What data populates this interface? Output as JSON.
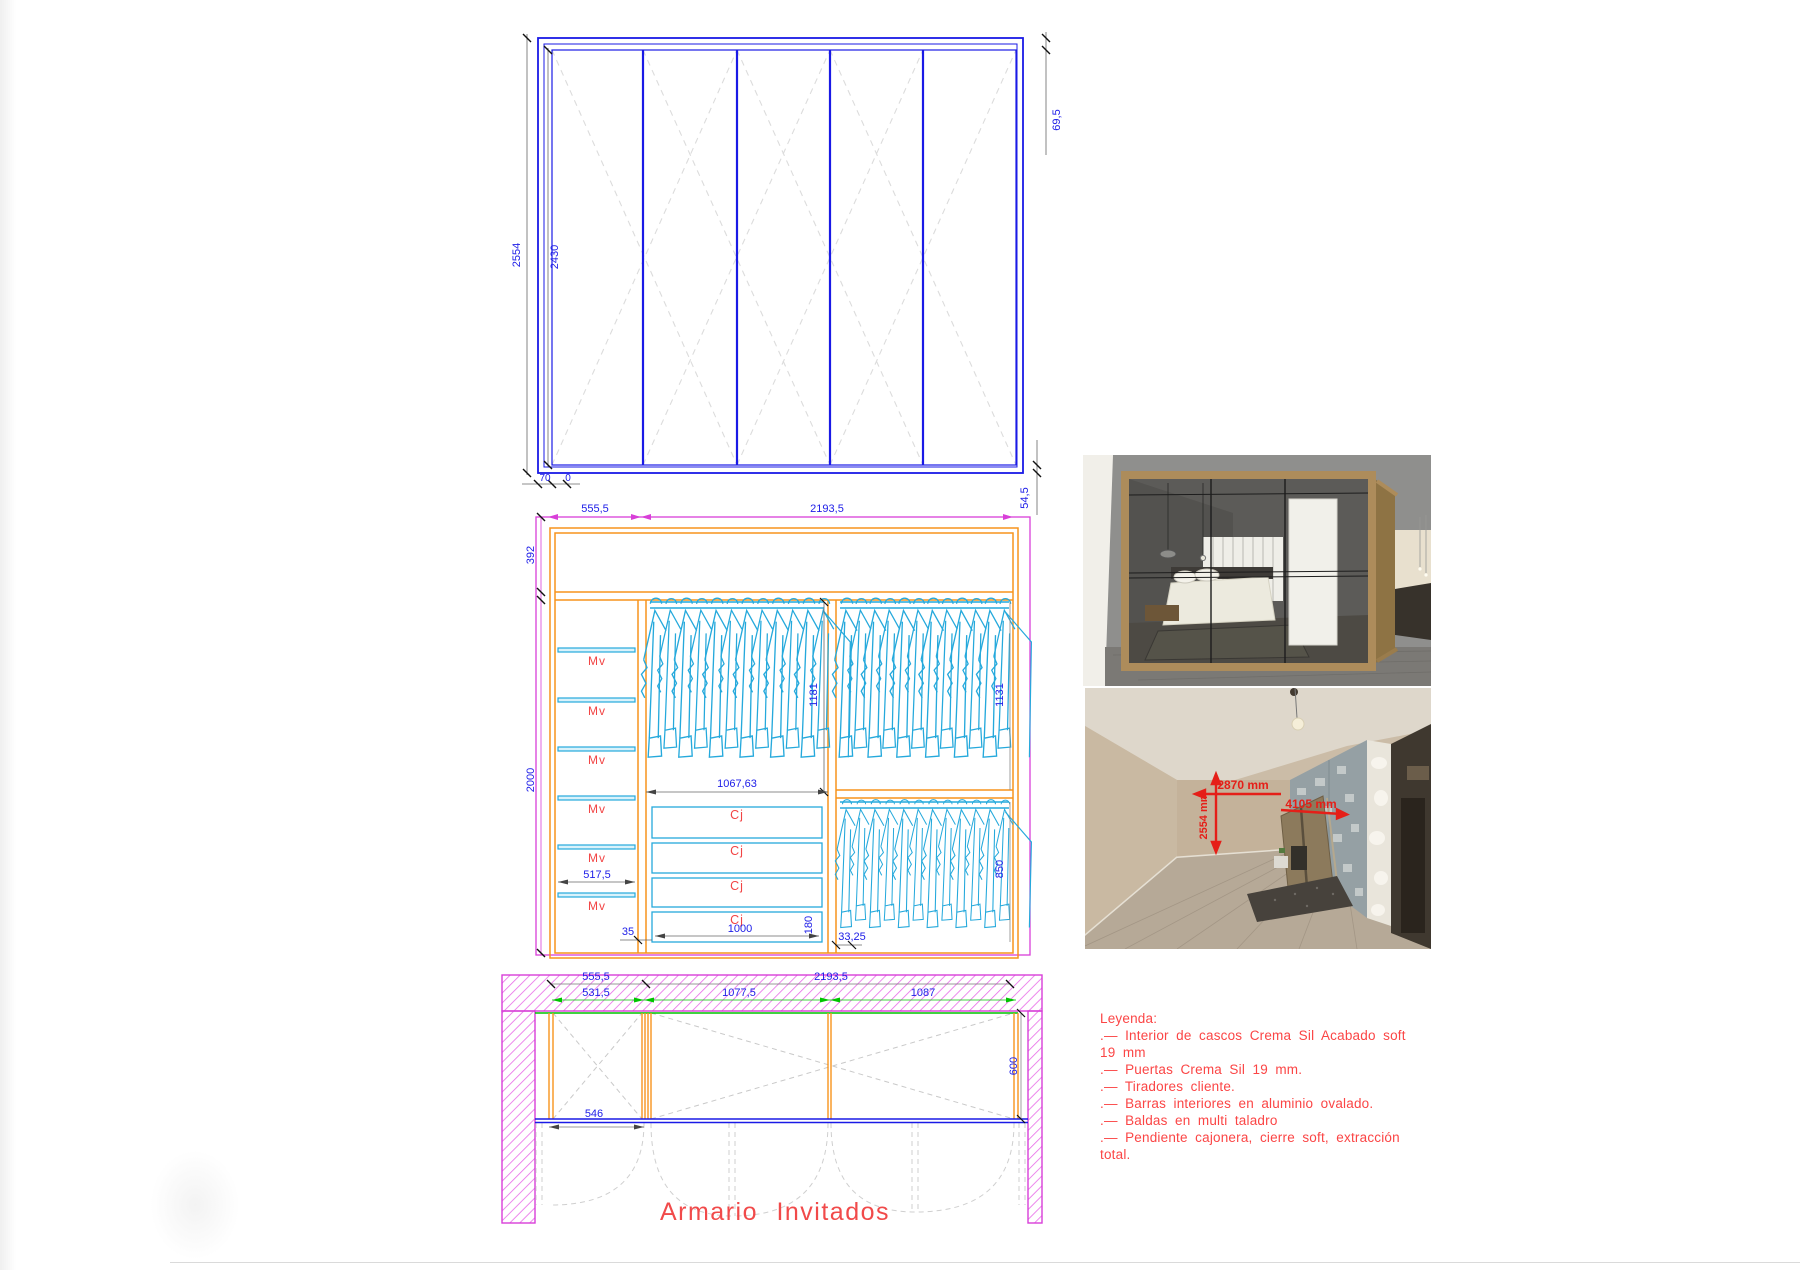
{
  "title": "Armario Invitados",
  "colors": {
    "line_blue": "#1a1ae6",
    "dim_blue": "#2020e8",
    "orange": "#f7941d",
    "cyan": "#25a9dc",
    "magenta": "#d83fd8",
    "green": "#00c400",
    "red_text": "#f24444",
    "photo_red": "#e51f18"
  },
  "elevation": {
    "door_count": 5,
    "dims": {
      "total_height": "2554",
      "door_height": "2430",
      "top_gap": "69,5",
      "bottom_offset": "70",
      "bottom_zero": "0",
      "side_gap": "54,5"
    }
  },
  "section": {
    "dims": {
      "left_width": "555,5",
      "right_width": "2193,5",
      "top_height": "392",
      "body_height": "2000",
      "shelf_width": "517,5",
      "left_rod_height": "1181",
      "rod_width": "1067,63",
      "right_rod_height": "1131",
      "lower_rod_height": "850",
      "drawer_width": "1000",
      "drawer_height": "180",
      "base_left": "35",
      "base_right": "33,25"
    },
    "shelf_label": "Mv",
    "shelf_count": 6,
    "drawer_label": "Cj",
    "drawer_count": 4,
    "hanger_groups": [
      {
        "count": 12
      },
      {
        "count": 12
      },
      {
        "count": 12
      }
    ]
  },
  "plan": {
    "dims": {
      "left_width": "555,5",
      "right_width": "2193,5",
      "bay_left": "531,5",
      "bay_mid": "1077,5",
      "bay_right": "1087",
      "depth": "600",
      "door_width": "546"
    }
  },
  "photos": {
    "site_dims": {
      "height": "2554 mm",
      "depth": "2870 mm",
      "width": "4105 mm"
    }
  },
  "legend": {
    "lines": [
      "Leyenda:",
      ".— Interior de cascos Crema Sil Acabado soft",
      "19 mm",
      ".— Puertas Crema Sil 19 mm.",
      ".— Tiradores cliente.",
      ".— Barras interiores en aluminio ovalado.",
      ".— Baldas en multi taladro",
      ".— Pendiente cajonera, cierre soft, extracción",
      "total."
    ]
  }
}
